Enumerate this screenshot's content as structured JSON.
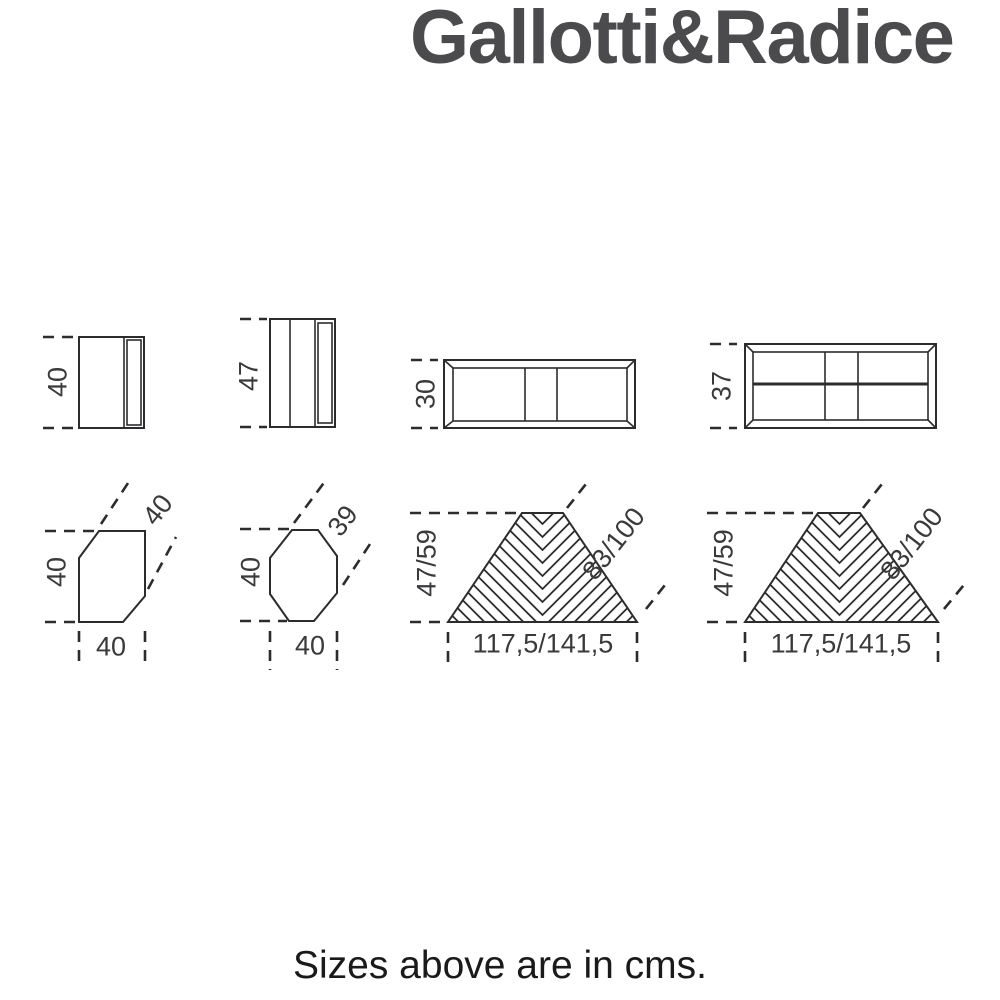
{
  "brand": {
    "logo_text": "Gallotti&Radice"
  },
  "footer": {
    "caption": "Sizes above are in cms."
  },
  "colors": {
    "background": "#ffffff",
    "line": "#2c2c2e",
    "dimension_text": "#3a3a3c",
    "logo": "#4b4b4d",
    "caption": "#1a1a1c"
  },
  "units": "cms",
  "drawings": {
    "elevation_side_small": {
      "height": "40"
    },
    "elevation_side_tall": {
      "height": "47"
    },
    "elevation_front_low": {
      "height": "30"
    },
    "elevation_front_high": {
      "height": "37"
    },
    "plan_hexagon": {
      "depth": "40",
      "diagonal_side": "40",
      "width": "40"
    },
    "plan_octagon": {
      "depth": "40",
      "diagonal_side": "39",
      "width": "40"
    },
    "plan_trapezoid_left": {
      "depth": "47/59",
      "diagonal_side": "83/100",
      "width": "117,5/141,5"
    },
    "plan_trapezoid_right": {
      "depth": "47/59",
      "diagonal_side": "83/100",
      "width": "117,5/141,5"
    }
  }
}
